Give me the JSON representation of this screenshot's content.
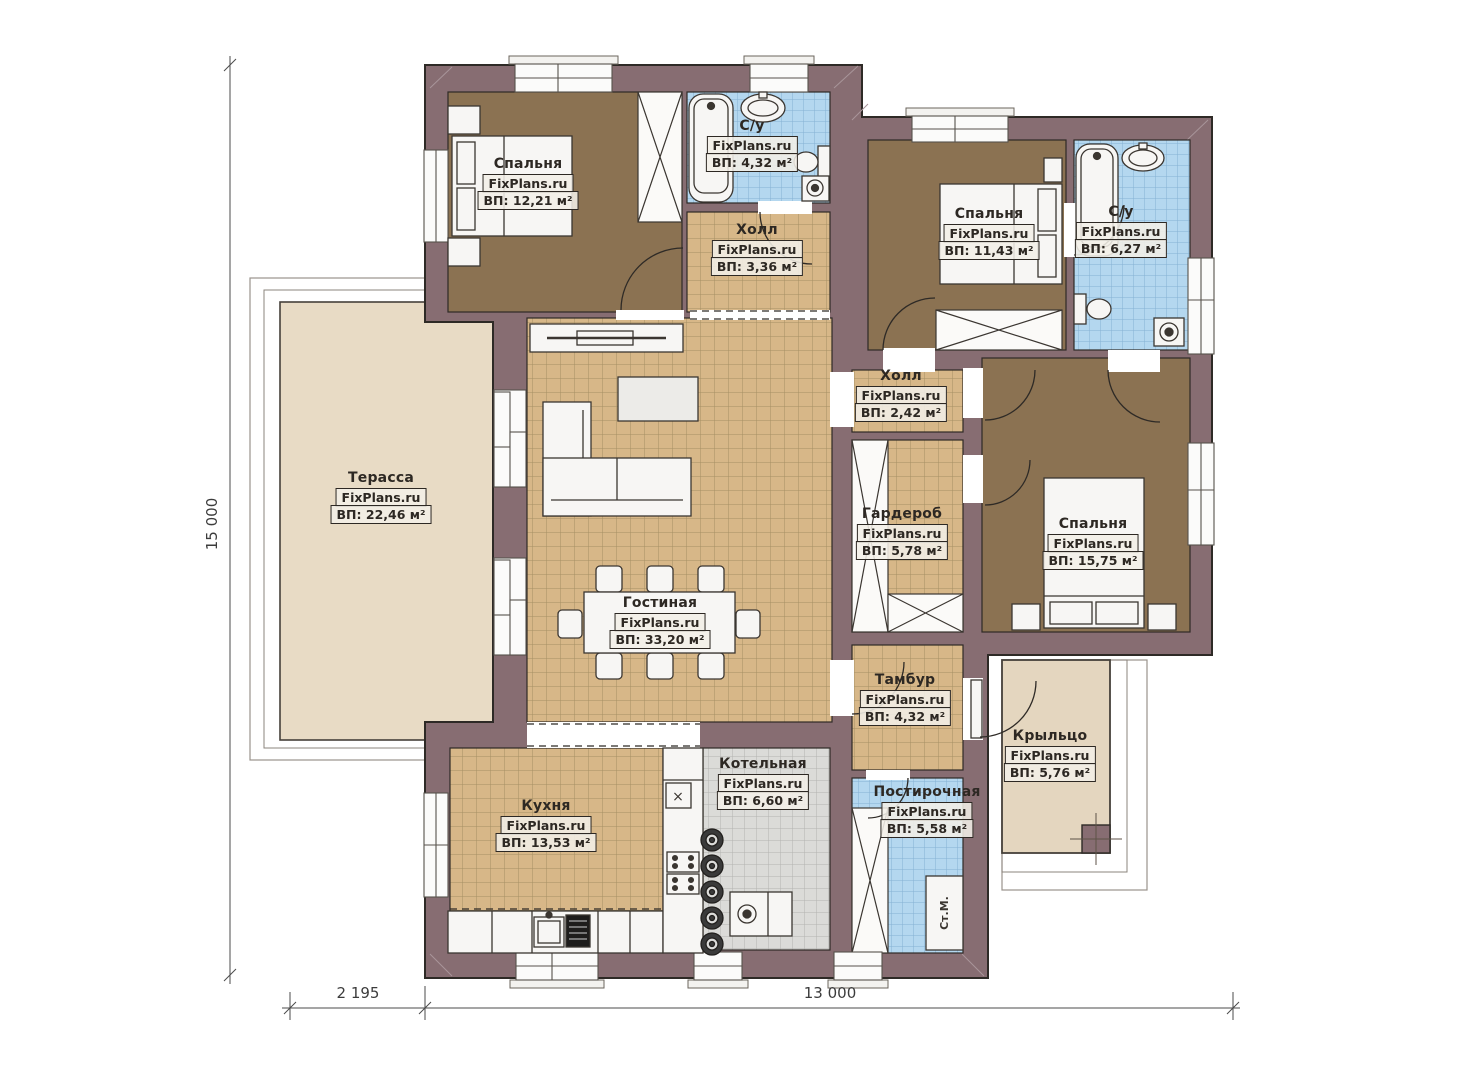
{
  "watermark": "FixPlans.ru",
  "rooms": {
    "bedroom1": {
      "name": "Спальня",
      "area": "ВП: 12,21 м²"
    },
    "bath1": {
      "name": "С/у",
      "area": "ВП: 4,32 м²"
    },
    "hall1": {
      "name": "Холл",
      "area": "ВП: 3,36 м²"
    },
    "bedroom2": {
      "name": "Спальня",
      "area": "ВП: 11,43 м²"
    },
    "bath2": {
      "name": "С/у",
      "area": "ВП: 6,27 м²"
    },
    "terrace": {
      "name": "Терасса",
      "area": "ВП: 22,46 м²"
    },
    "hall2": {
      "name": "Холл",
      "area": "ВП: 2,42 м²"
    },
    "wardrobe": {
      "name": "Гардероб",
      "area": "ВП: 5,78 м²"
    },
    "bedroom3": {
      "name": "Спальня",
      "area": "ВП: 15,75 м²"
    },
    "living": {
      "name": "Гостиная",
      "area": "ВП: 33,20 м²"
    },
    "tambur": {
      "name": "Тамбур",
      "area": "ВП: 4,32 м²"
    },
    "porch": {
      "name": "Крыльцо",
      "area": "ВП: 5,76 м²"
    },
    "kitchen": {
      "name": "Кухня",
      "area": "ВП: 13,53 м²"
    },
    "boiler": {
      "name": "Котельная",
      "area": "ВП: 6,60 м²"
    },
    "laundry": {
      "name": "Постирочная",
      "area": "ВП: 5,58 м²"
    }
  },
  "dimensions": {
    "left": "15 000",
    "bottom_left": "2 195",
    "bottom_right": "13 000"
  },
  "annotations": {
    "washing_machine": "Ст.М.",
    "kitchen_marker": "×"
  },
  "colors": {
    "wall": "#876d72",
    "floor_brown": "#8b7252",
    "tile_tan": "#d7b788",
    "tile_blue": "#b4d7ef",
    "tile_gray": "#dbdbd8",
    "terrace": "#e8dbc5",
    "porch": "#e4d6bf"
  }
}
